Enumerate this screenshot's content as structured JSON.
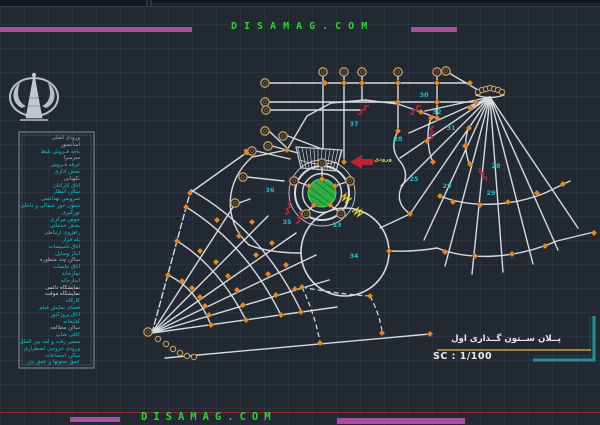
{
  "watermark": {
    "text": "DISAMAG.COM"
  },
  "titleblock": {
    "title": "پــلان ســتون گــذاری اول",
    "scale": "SC : 1/100"
  },
  "colors": {
    "accent_magenta": "#a84f9e",
    "accent_green": "#35cf3b",
    "wall_white": "#d9dade",
    "marker_orange": "#e08a2d",
    "room_number_cyan": "#1ac0c6",
    "stair_red": "#a52a3a",
    "lawn_green": "#2fae45",
    "frame_teal": "#2d8a93",
    "underline_yellow": "#c8a23c"
  },
  "plan": {
    "arrow_label": "ورودی",
    "number_color": "#1ac0c6",
    "room_numbers": [
      {
        "n": "25",
        "x": 414,
        "y": 179
      },
      {
        "n": "28",
        "x": 398,
        "y": 139
      },
      {
        "n": "28",
        "x": 496,
        "y": 166
      },
      {
        "n": "29",
        "x": 447,
        "y": 186
      },
      {
        "n": "29",
        "x": 491,
        "y": 193
      },
      {
        "n": "30",
        "x": 424,
        "y": 95
      },
      {
        "n": "31",
        "x": 451,
        "y": 128
      },
      {
        "n": "32",
        "x": 437,
        "y": 112
      },
      {
        "n": "33",
        "x": 337,
        "y": 225
      },
      {
        "n": "34",
        "x": 354,
        "y": 256
      },
      {
        "n": "35",
        "x": 287,
        "y": 222
      },
      {
        "n": "36",
        "x": 270,
        "y": 190
      },
      {
        "n": "37",
        "x": 354,
        "y": 124
      }
    ]
  },
  "legend": {
    "items": [
      {
        "text": "ورودی اصلی",
        "color": "#a6adb4"
      },
      {
        "text": "آسانسور",
        "color": "#a6adb4"
      },
      {
        "text": "باجه فـروش بلیط",
        "color": "#17c3c9"
      },
      {
        "text": "سرسرا",
        "color": "#a6adb4"
      },
      {
        "text": "غرفه فـروش",
        "color": "#17c3c9"
      },
      {
        "text": "بخش اداری",
        "color": "#17c3c9"
      },
      {
        "text": "نگهبانی",
        "color": "#a6adb4"
      },
      {
        "text": "اتاق کارکنان",
        "color": "#17c3c9"
      },
      {
        "text": "سالن انتظار",
        "color": "#17c3c9"
      },
      {
        "text": "سرویس بهداشتی",
        "color": "#17c3c9"
      },
      {
        "text": "ستون خور شمالی و داخلی",
        "color": "#17c3c9"
      },
      {
        "text": "نورگیری",
        "color": "#17c3c9"
      },
      {
        "text": "حوض مرکزی",
        "color": "#17c3c9"
      },
      {
        "text": "بخش خدماتی",
        "color": "#17c3c9"
      },
      {
        "text": "راهروی ارتباطی",
        "color": "#17c3c9"
      },
      {
        "text": "پله فرار",
        "color": "#17c3c9"
      },
      {
        "text": "اتاق تاسیسات",
        "color": "#17c3c9"
      },
      {
        "text": "انبار وسایل",
        "color": "#17c3c9"
      },
      {
        "text": "سالن چند منظوره",
        "color": "#a6adb4"
      },
      {
        "text": "اتاق جلسات",
        "color": "#17c3c9"
      },
      {
        "text": "نمازخانه",
        "color": "#17c3c9"
      },
      {
        "text": "آبدارخانه",
        "color": "#17c3c9"
      },
      {
        "text": "نمایشگاه دائمی",
        "color": "#d2d6da"
      },
      {
        "text": "نمایشگاه موقت",
        "color": "#d2d6da"
      },
      {
        "text": "کارگاه",
        "color": "#17c3c9"
      },
      {
        "text": "فضای نمایش فیلم",
        "color": "#17c3c9"
      },
      {
        "text": "اتاق پروژکتور",
        "color": "#17c3c9"
      },
      {
        "text": "کتابخانه",
        "color": "#17c3c9"
      },
      {
        "text": "سالن مطالعه",
        "color": "#a6adb4"
      },
      {
        "text": "کافی شاپ",
        "color": "#17c3c9"
      },
      {
        "text": "مسیر رفت و آمد بین الملل",
        "color": "#17c3c9"
      },
      {
        "text": "ورودی خروجی اضطراری",
        "color": "#17c3c9"
      },
      {
        "text": "سالن اجتماعات",
        "color": "#17c3c9"
      },
      {
        "text": "عمق ستونها و عمق بتن",
        "color": "#17c3c9"
      }
    ]
  }
}
